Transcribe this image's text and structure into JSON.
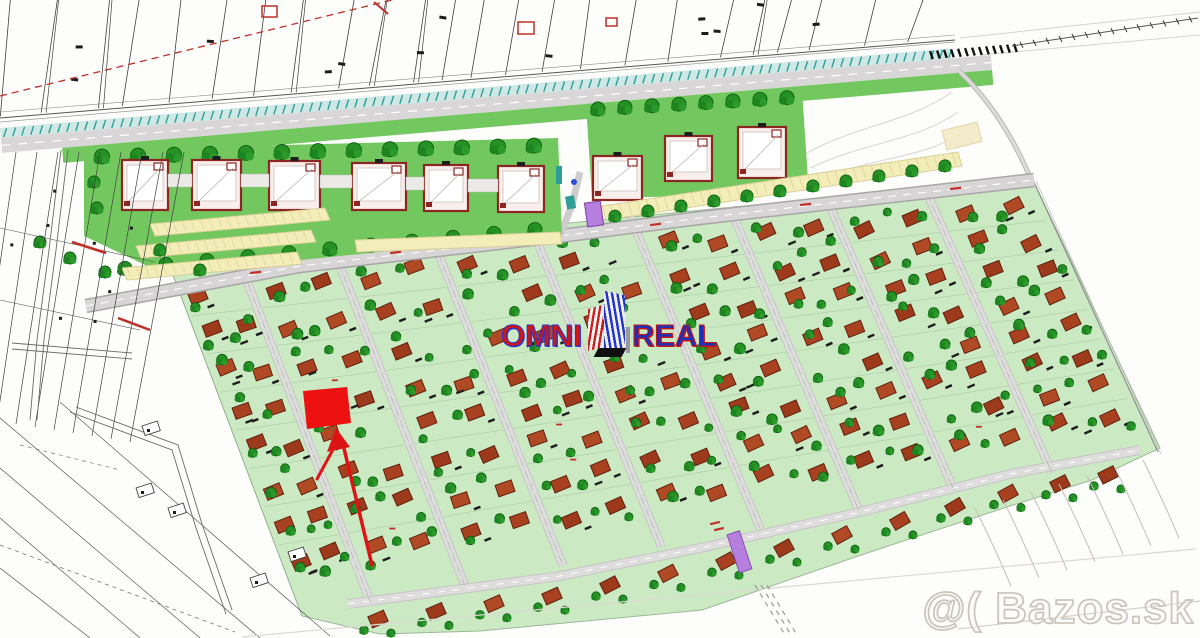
{
  "logo": {
    "omni": "OMNI",
    "real": "REAL"
  },
  "watermark": {
    "text": "@( Bazos.sk"
  },
  "palette": {
    "field_green": "#cbe9c3",
    "apt_green": "#72c75f",
    "tree_green": "#259125",
    "tree_dark": "#0e5c10",
    "house_red": "#a84120",
    "house_outline": "#5f2310",
    "road_fill": "#d8d6d6",
    "road_edge": "#a8a6a6",
    "parking_yellow": "#f3edba",
    "apt_block_fill": "#f8efec",
    "apt_block_border": "#8c2620",
    "corridor_teal": "#2f9e99",
    "corridor_teal_bg": "#cfe8e5",
    "purple": "#b77fdd",
    "highlight_red": "#ee1111",
    "arrow_red": "#dd1414",
    "cadastre_line": "#3f3f3f",
    "contour_gray": "#d8d4cf",
    "red_mark": "#c03028",
    "black_mark": "#1c1c1c"
  },
  "field": {
    "corners": {
      "top_left": [
        168,
        262
      ],
      "top_right": [
        1032,
        178
      ],
      "bottom_left": [
        302,
        616
      ],
      "bottom_right": [
        1158,
        452
      ]
    },
    "strip_fractions": [
      0,
      0.08,
      0.19,
      0.305,
      0.42,
      0.535,
      0.65,
      0.762,
      0.876,
      1
    ],
    "rows_per_strip": 8,
    "bottom_row_x": [
      378,
      436,
      494,
      552,
      610,
      668,
      726,
      784,
      842,
      900,
      955,
      1008,
      1060,
      1108
    ]
  },
  "apartments": {
    "left_blocks": [
      [
        122,
        160,
        46,
        50
      ],
      [
        192,
        160,
        49,
        50
      ],
      [
        269,
        161,
        51,
        49
      ],
      [
        352,
        163,
        54,
        47
      ],
      [
        424,
        165,
        44,
        46
      ],
      [
        498,
        166,
        46,
        46
      ]
    ],
    "right_blocks": [
      [
        593,
        156,
        49,
        44
      ],
      [
        665,
        136,
        47,
        45
      ],
      [
        738,
        127,
        48,
        51
      ]
    ]
  }
}
